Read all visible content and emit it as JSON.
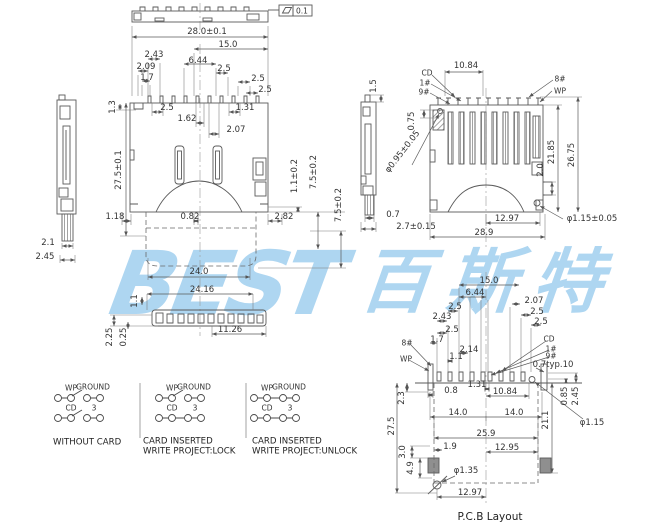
{
  "colors": {
    "line": "#5a5a5a",
    "text": "#333333",
    "watermark": "#aed6f1",
    "pad_fill": "#8f8f8f",
    "background": "#ffffff"
  },
  "flatness": {
    "symbol": "parallelogram",
    "value": "0.1"
  },
  "watermark": {
    "latin": "BEST",
    "cjk": "百斯特"
  },
  "front": {
    "dims": [
      "28.0±0.1",
      "15.0",
      "2.43",
      "2.09",
      "1.7",
      "6.44",
      "2.5",
      "2.5",
      "2.5",
      "1.3",
      "2.5",
      "1.31",
      "1.62",
      "2.07",
      "27.5±0.1",
      "1.18",
      "0.82",
      "2.82",
      "1.1±0.2",
      "7.5±0.2",
      "7.5±0.2",
      "24.0",
      "24.16",
      "1.1",
      "11.26",
      "2.25",
      "0.25"
    ]
  },
  "left": {
    "dims": [
      "2.1",
      "2.45"
    ]
  },
  "mid": {
    "dims": [
      "1.5",
      "0.7",
      "2.7±0.15"
    ]
  },
  "right": {
    "dims": [
      "10.84",
      "0.75",
      "φ0.95±0.05",
      "21.85",
      "26.75",
      "2.0",
      "12.97",
      "28.9",
      "φ1.15±0.05"
    ],
    "pins": [
      "CD",
      "1#",
      "9#",
      "8#",
      "WP"
    ]
  },
  "pcb": {
    "dims": [
      "15.0",
      "6.44",
      "2.07",
      "2.5",
      "2.43",
      "2.5",
      "2.5",
      "2.5",
      "1.7",
      "2.14",
      "1.1",
      "0.7typ.10",
      "1.31",
      "0.8",
      "10.84",
      "2.3",
      "27.5",
      "14.0",
      "14.0",
      "21.1",
      "0.85",
      "2.45",
      "φ1.15",
      "25.9",
      "1.9",
      "12.95",
      "3.0",
      "4.9",
      "φ1.35",
      "12.97"
    ],
    "pins": [
      "8#",
      "WP",
      "CD",
      "1#",
      "9#"
    ],
    "caption": "P.C.B Layout"
  },
  "switches": {
    "col_labels": [
      "WP",
      "GROUND",
      "CD",
      "3"
    ],
    "states": [
      {
        "lines": [
          "WITHOUT CARD"
        ]
      },
      {
        "lines": [
          "CARD INSERTED",
          "WRITE PROJECT:LOCK"
        ]
      },
      {
        "lines": [
          "CARD INSERTED",
          "WRITE PROJECT:UNLOCK"
        ]
      }
    ]
  }
}
